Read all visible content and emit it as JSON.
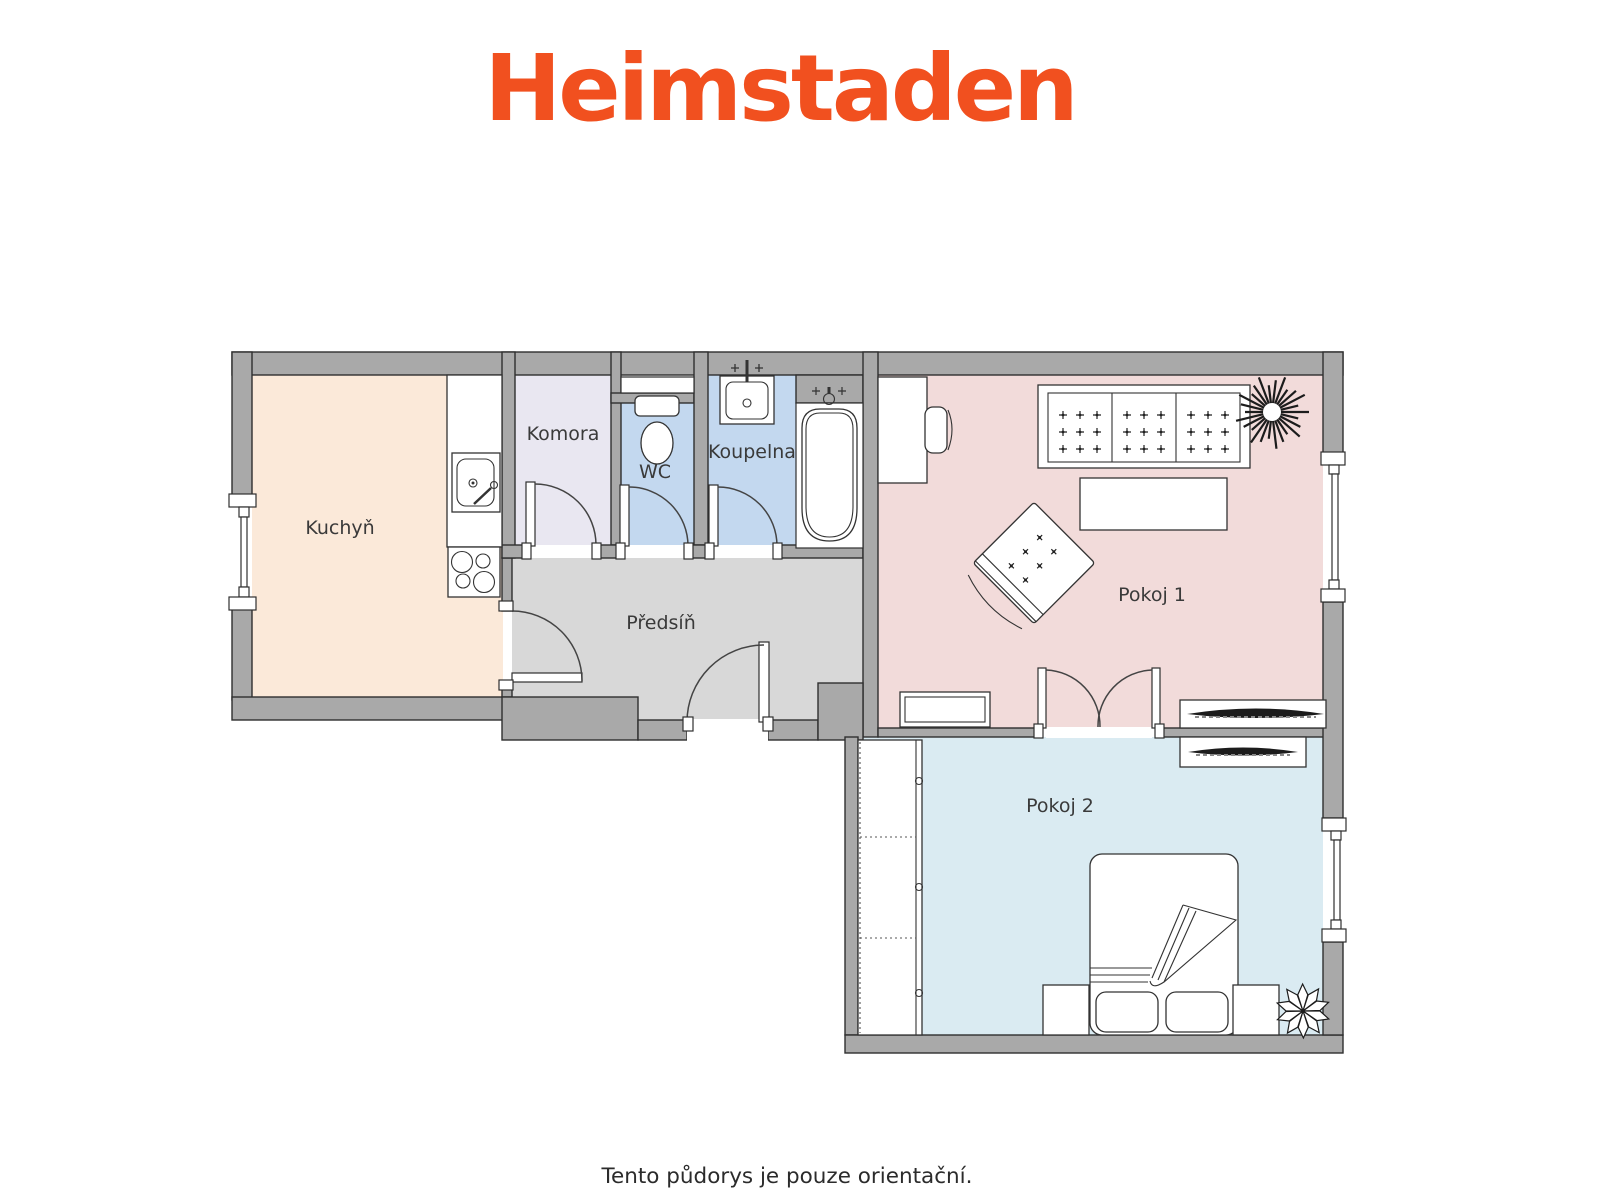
{
  "logo": {
    "text": "Heimstaden"
  },
  "caption": "Tento půdorys je pouze orientační.",
  "palette": {
    "brand": "#F1501F",
    "wall": "#A9A9A9",
    "kitchen": "#FBE9D9",
    "pantry": "#E9E7F1",
    "wc": "#C3D8EF",
    "bathroom": "#C3D8EF",
    "hallway": "#D8D8D8",
    "room1": "#F2DBDA",
    "room2": "#DAEBF2"
  },
  "rooms": {
    "kitchen": {
      "label": "Kuchyň"
    },
    "pantry": {
      "label": "Komora"
    },
    "wc": {
      "label": "WC"
    },
    "bathroom": {
      "label": "Koupelna"
    },
    "hallway": {
      "label": "Předsíň"
    },
    "room1": {
      "label": "Pokoj 1"
    },
    "room2": {
      "label": "Pokoj 2"
    }
  }
}
